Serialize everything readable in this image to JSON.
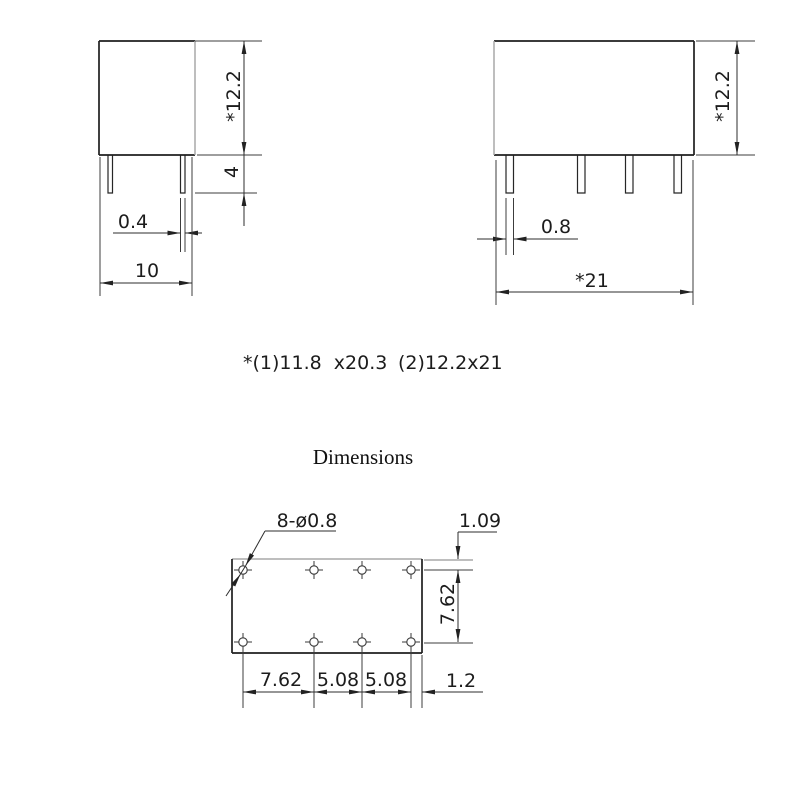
{
  "drawing": {
    "side_view": {
      "height_label": "*12.2",
      "pin_length_label": "4",
      "pin_width_label": "0.4",
      "body_width_label": "10"
    },
    "front_view": {
      "height_label": "*12.2",
      "pin_width_label": "0.8",
      "body_width_label": "*21"
    },
    "note_left": "*(1)11.8  x20.3",
    "note_right": "(2)12.2x21",
    "section_title": "Dimensions",
    "footprint": {
      "holes_label": "8-ø0.8",
      "top_offset_label": "1.09",
      "row_spacing_label": "7.62",
      "col_spacing_labels": [
        "7.62",
        "5.08",
        "5.08"
      ],
      "right_offset_label": "1.2"
    },
    "colors": {
      "line": "#2e2e2e",
      "body_line": "#1f1f1f",
      "gray_line": "#a9a9a9",
      "text": "#1c1c1c",
      "background": "#ffffff"
    }
  }
}
